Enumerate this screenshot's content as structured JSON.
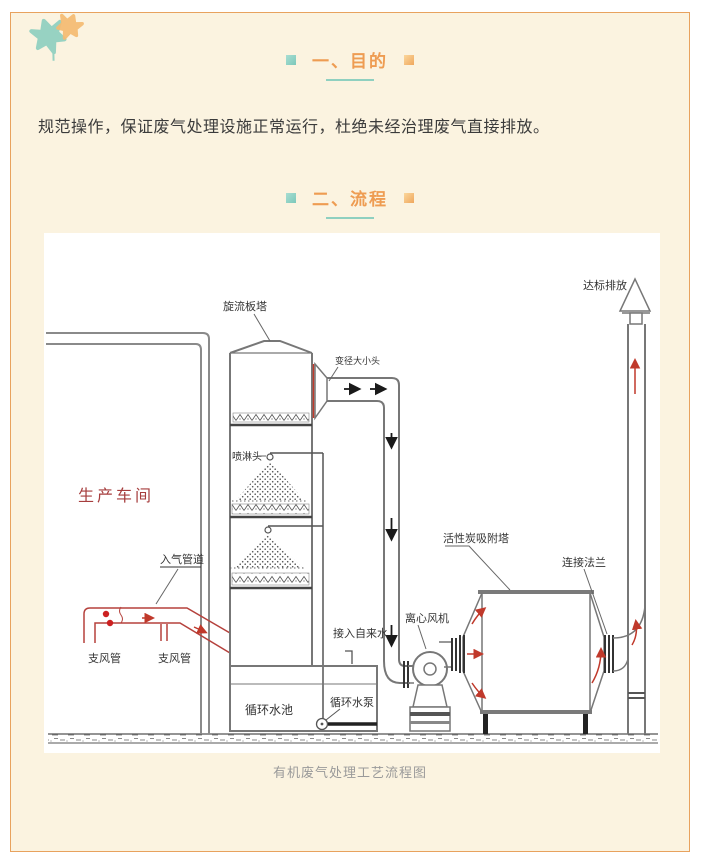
{
  "page": {
    "colors": {
      "background": "#ffffff",
      "card_background": "#fbf3e0",
      "card_border": "#e8a25e",
      "heading_orange": "#ee9c52",
      "teal_accent": "#8fd0c0",
      "orange_accent": "#f5bb72",
      "body_text": "#3b3b3b",
      "caption_gray": "#9a9a9a",
      "diagram_line_gray": "#777777",
      "diagram_red": "#c0392b",
      "workshop_label_red": "#a63d3d"
    }
  },
  "sections": {
    "purpose": {
      "heading": "一、目的",
      "body": "规范操作，保证废气处理设施正常运行，杜绝未经治理废气直接排放。"
    },
    "process": {
      "heading": "二、流程"
    }
  },
  "diagram": {
    "caption": "有机废气处理工艺流程图",
    "labels": {
      "cyclone_tower": "旋流板塔",
      "reducer": "变径大小头",
      "spray_head": "喷淋头",
      "workshop": "生产车间",
      "inlet_duct": "入气管道",
      "branch_duct_left": "支风管",
      "branch_duct_right": "支风管",
      "tap_water": "接入自来水",
      "pool": "循环水池",
      "pump": "循环水泵",
      "fan": "离心风机",
      "carbon_tower": "活性炭吸附塔",
      "flange": "连接法兰",
      "discharge": "达标排放"
    }
  }
}
